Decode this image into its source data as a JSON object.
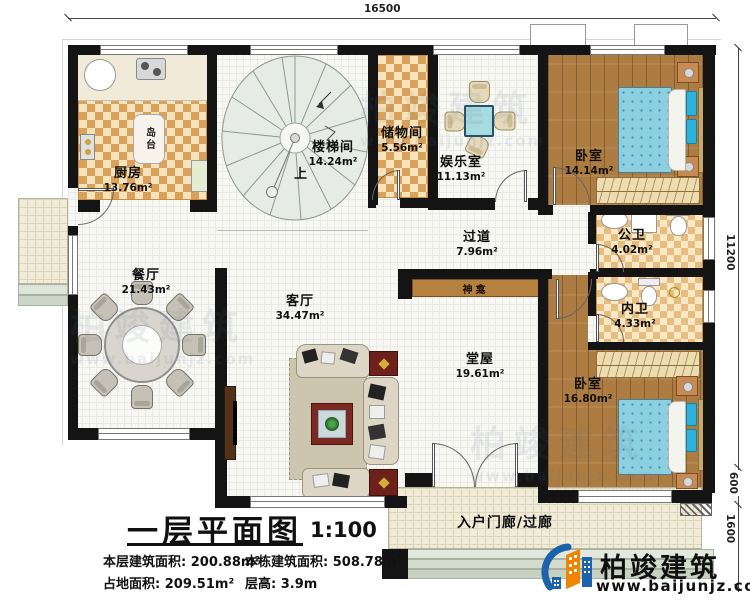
{
  "plan": {
    "dims": {
      "top": "16500",
      "right": "11200",
      "step": "600",
      "porch_depth": "1600"
    },
    "rooms": {
      "kitchen": {
        "name": "厨房",
        "area": "13.76m²"
      },
      "island": {
        "name": "岛台"
      },
      "stair": {
        "name": "楼梯间",
        "area": "14.24m²",
        "up": "上"
      },
      "storage": {
        "name": "储物间",
        "area": "5.56m²"
      },
      "recreation": {
        "name": "娱乐室",
        "area": "11.13m²"
      },
      "bedroom1": {
        "name": "卧室",
        "area": "14.14m²"
      },
      "pubbath": {
        "name": "公卫",
        "area": "4.02m²"
      },
      "privbath": {
        "name": "内卫",
        "area": "4.33m²"
      },
      "bedroom2": {
        "name": "卧室",
        "area": "16.80m²"
      },
      "corridor": {
        "name": "过道",
        "area": "7.96m²"
      },
      "shrine": {
        "name": "神龛"
      },
      "hall": {
        "name": "堂屋",
        "area": "19.61m²"
      },
      "living": {
        "name": "客厅",
        "area": "34.47m²"
      },
      "dining": {
        "name": "餐厅",
        "area": "21.43m²"
      },
      "porch": {
        "name": "入户门廊/过廊"
      }
    },
    "titleblock": {
      "title": "一层平面图",
      "scale": "1:100",
      "stats": [
        {
          "label": "本层建筑面积:",
          "value": "200.88m²"
        },
        {
          "label": "本栋建筑面积:",
          "value": "508.78m²"
        },
        {
          "label": "占地面积:",
          "value": "209.51m²"
        },
        {
          "label": "层高:",
          "value": "3.9m"
        }
      ]
    },
    "brand": {
      "name": "柏竣建筑",
      "url": "www.baijunjz.com"
    }
  },
  "colors": {
    "wall": "#141414",
    "checker": "#d9a159",
    "wood": "#ad7c42",
    "bed_blue": "#8ccfe0",
    "brand_blue": "#1c63ac",
    "brand_orange": "#f08300"
  }
}
